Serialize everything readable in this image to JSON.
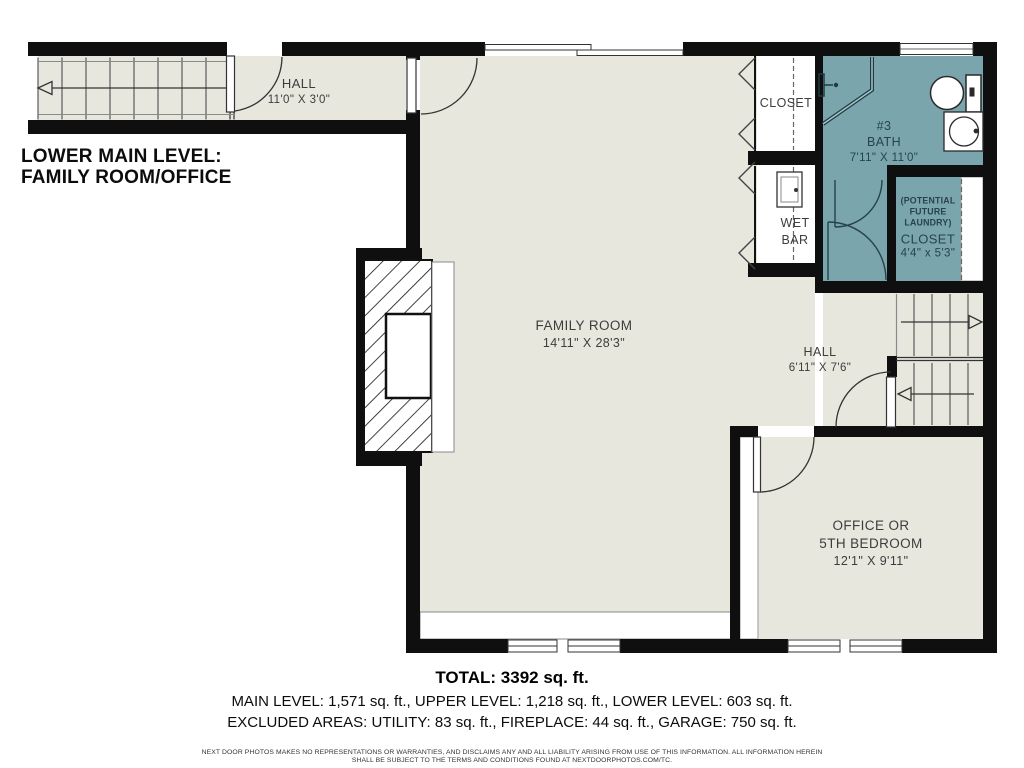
{
  "floorplan": {
    "title_line1": "LOWER MAIN LEVEL:",
    "title_line2": "FAMILY ROOM/OFFICE",
    "rooms": {
      "hall_top": {
        "name": "HALL",
        "dims": "11'0\" X 3'0\""
      },
      "family_room": {
        "name": "FAMILY ROOM",
        "dims": "14'11\" X 28'3\""
      },
      "closet": {
        "name": "CLOSET"
      },
      "wet_bar": {
        "name_line1": "WET",
        "name_line2": "BAR"
      },
      "bath": {
        "number": "#3",
        "name": "BATH",
        "dims": "7'11\" X 11'0\""
      },
      "laundry_closet": {
        "note_line1": "(POTENTIAL",
        "note_line2": "FUTURE",
        "note_line3": "LAUNDRY)",
        "name": "CLOSET",
        "dims": "4'4\" x 5'3\""
      },
      "hall_lower": {
        "name": "HALL",
        "dims": "6'11\" X 7'6\""
      },
      "office": {
        "name_line1": "OFFICE OR",
        "name_line2": "5TH BEDROOM",
        "dims": "12'1\" X 9'11\""
      }
    },
    "summary": {
      "total": "TOTAL: 3392 sq. ft.",
      "levels": "MAIN LEVEL: 1,571 sq. ft., UPPER LEVEL: 1,218 sq. ft., LOWER LEVEL: 603 sq. ft.",
      "excluded": "EXCLUDED AREAS: UTILITY: 83 sq. ft., FIREPLACE: 44 sq. ft., GARAGE: 750 sq. ft."
    },
    "disclaimer_line1": "NEXT DOOR PHOTOS MAKES NO REPRESENTATIONS OR WARRANTIES, AND DISCLAIMS ANY AND ALL LIABILITY ARISING FROM USE OF THIS INFORMATION. ALL INFORMATION HEREIN",
    "disclaimer_line2": "SHALL BE SUBJECT TO THE TERMS AND CONDITIONS FOUND AT NEXTDOORPHOTOS.COM/TC.",
    "colors": {
      "bath_fill": "#7BA5AC",
      "floor_fill": "#E8E7DE",
      "wall": "#0F0F0F"
    }
  }
}
